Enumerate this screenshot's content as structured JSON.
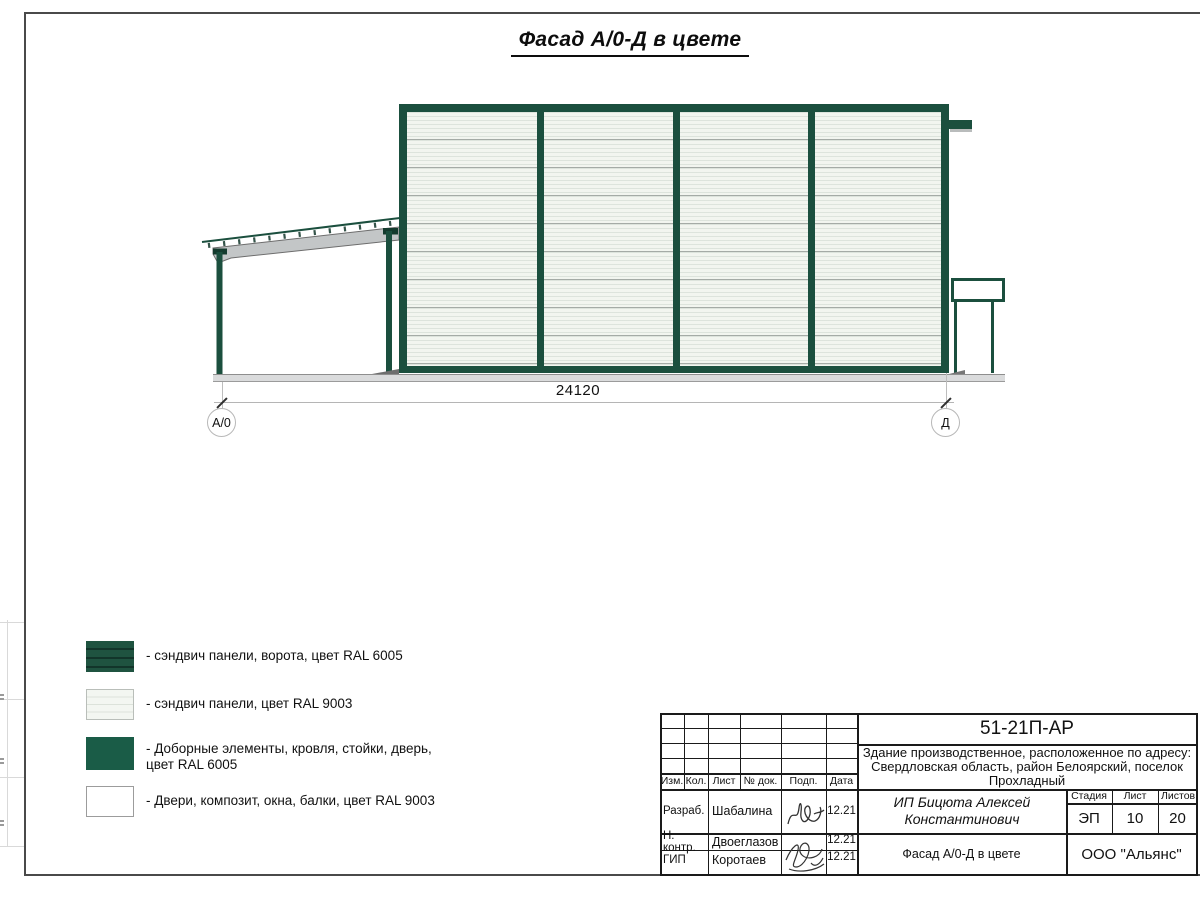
{
  "sheet": {
    "title": "Фасад А/0-Д в цвете"
  },
  "drawing": {
    "dimension_label": "24120",
    "axis_left": "А/0",
    "axis_right": "Д",
    "colors": {
      "ral_6005_green": "#1b4f3e",
      "ral_9003_white": "#f3f6f1",
      "beam_gray": "#c3c6c7",
      "ground_gray": "#dadbdc"
    }
  },
  "legend": {
    "items": [
      {
        "swatch": "sandwich-panel-gate-green",
        "label": "- сэндвич панели, ворота, цвет RAL 6005"
      },
      {
        "swatch": "sandwich-panel-white",
        "label": "- сэндвич панели, цвет RAL 9003"
      },
      {
        "swatch": "trim-roof-posts-door-green",
        "label": "- Доборные элементы, кровля, стойки, дверь, цвет RAL 6005"
      },
      {
        "swatch": "doors-composite-windows-beams-white",
        "label": "- Двери, композит, окна, балки, цвет RAL 9003"
      }
    ]
  },
  "title_block": {
    "doc_number": "51-21П-АР",
    "address_lines": [
      "Здание производственное, расположенное по адресу:",
      "Свердловская область, район Белоярский, поселок",
      "Прохладный"
    ],
    "client": "ИП Бицюта Алексей Константинович",
    "drawing_title": "Фасад А/0-Д в цвете",
    "organization": "ООО \"Альянс\"",
    "columns": {
      "izm": "Изм.",
      "kol": "Кол.",
      "list": "Лист",
      "doc": "№ док.",
      "podp": "Подп.",
      "data": "Дата"
    },
    "stage": {
      "header": "Стадия",
      "value": "ЭП"
    },
    "sheet_no": {
      "header": "Лист",
      "value": "10"
    },
    "sheets_total": {
      "header": "Листов",
      "value": "20"
    },
    "signature_rows": [
      {
        "role": "Разраб.",
        "name": "Шабалина",
        "date": "12.21"
      },
      {
        "role": "Н. контр.",
        "name": "Двоеглазов",
        "date": "12.21"
      },
      {
        "role": "ГИП",
        "name": "Коротаев",
        "date": "12.21"
      }
    ]
  }
}
